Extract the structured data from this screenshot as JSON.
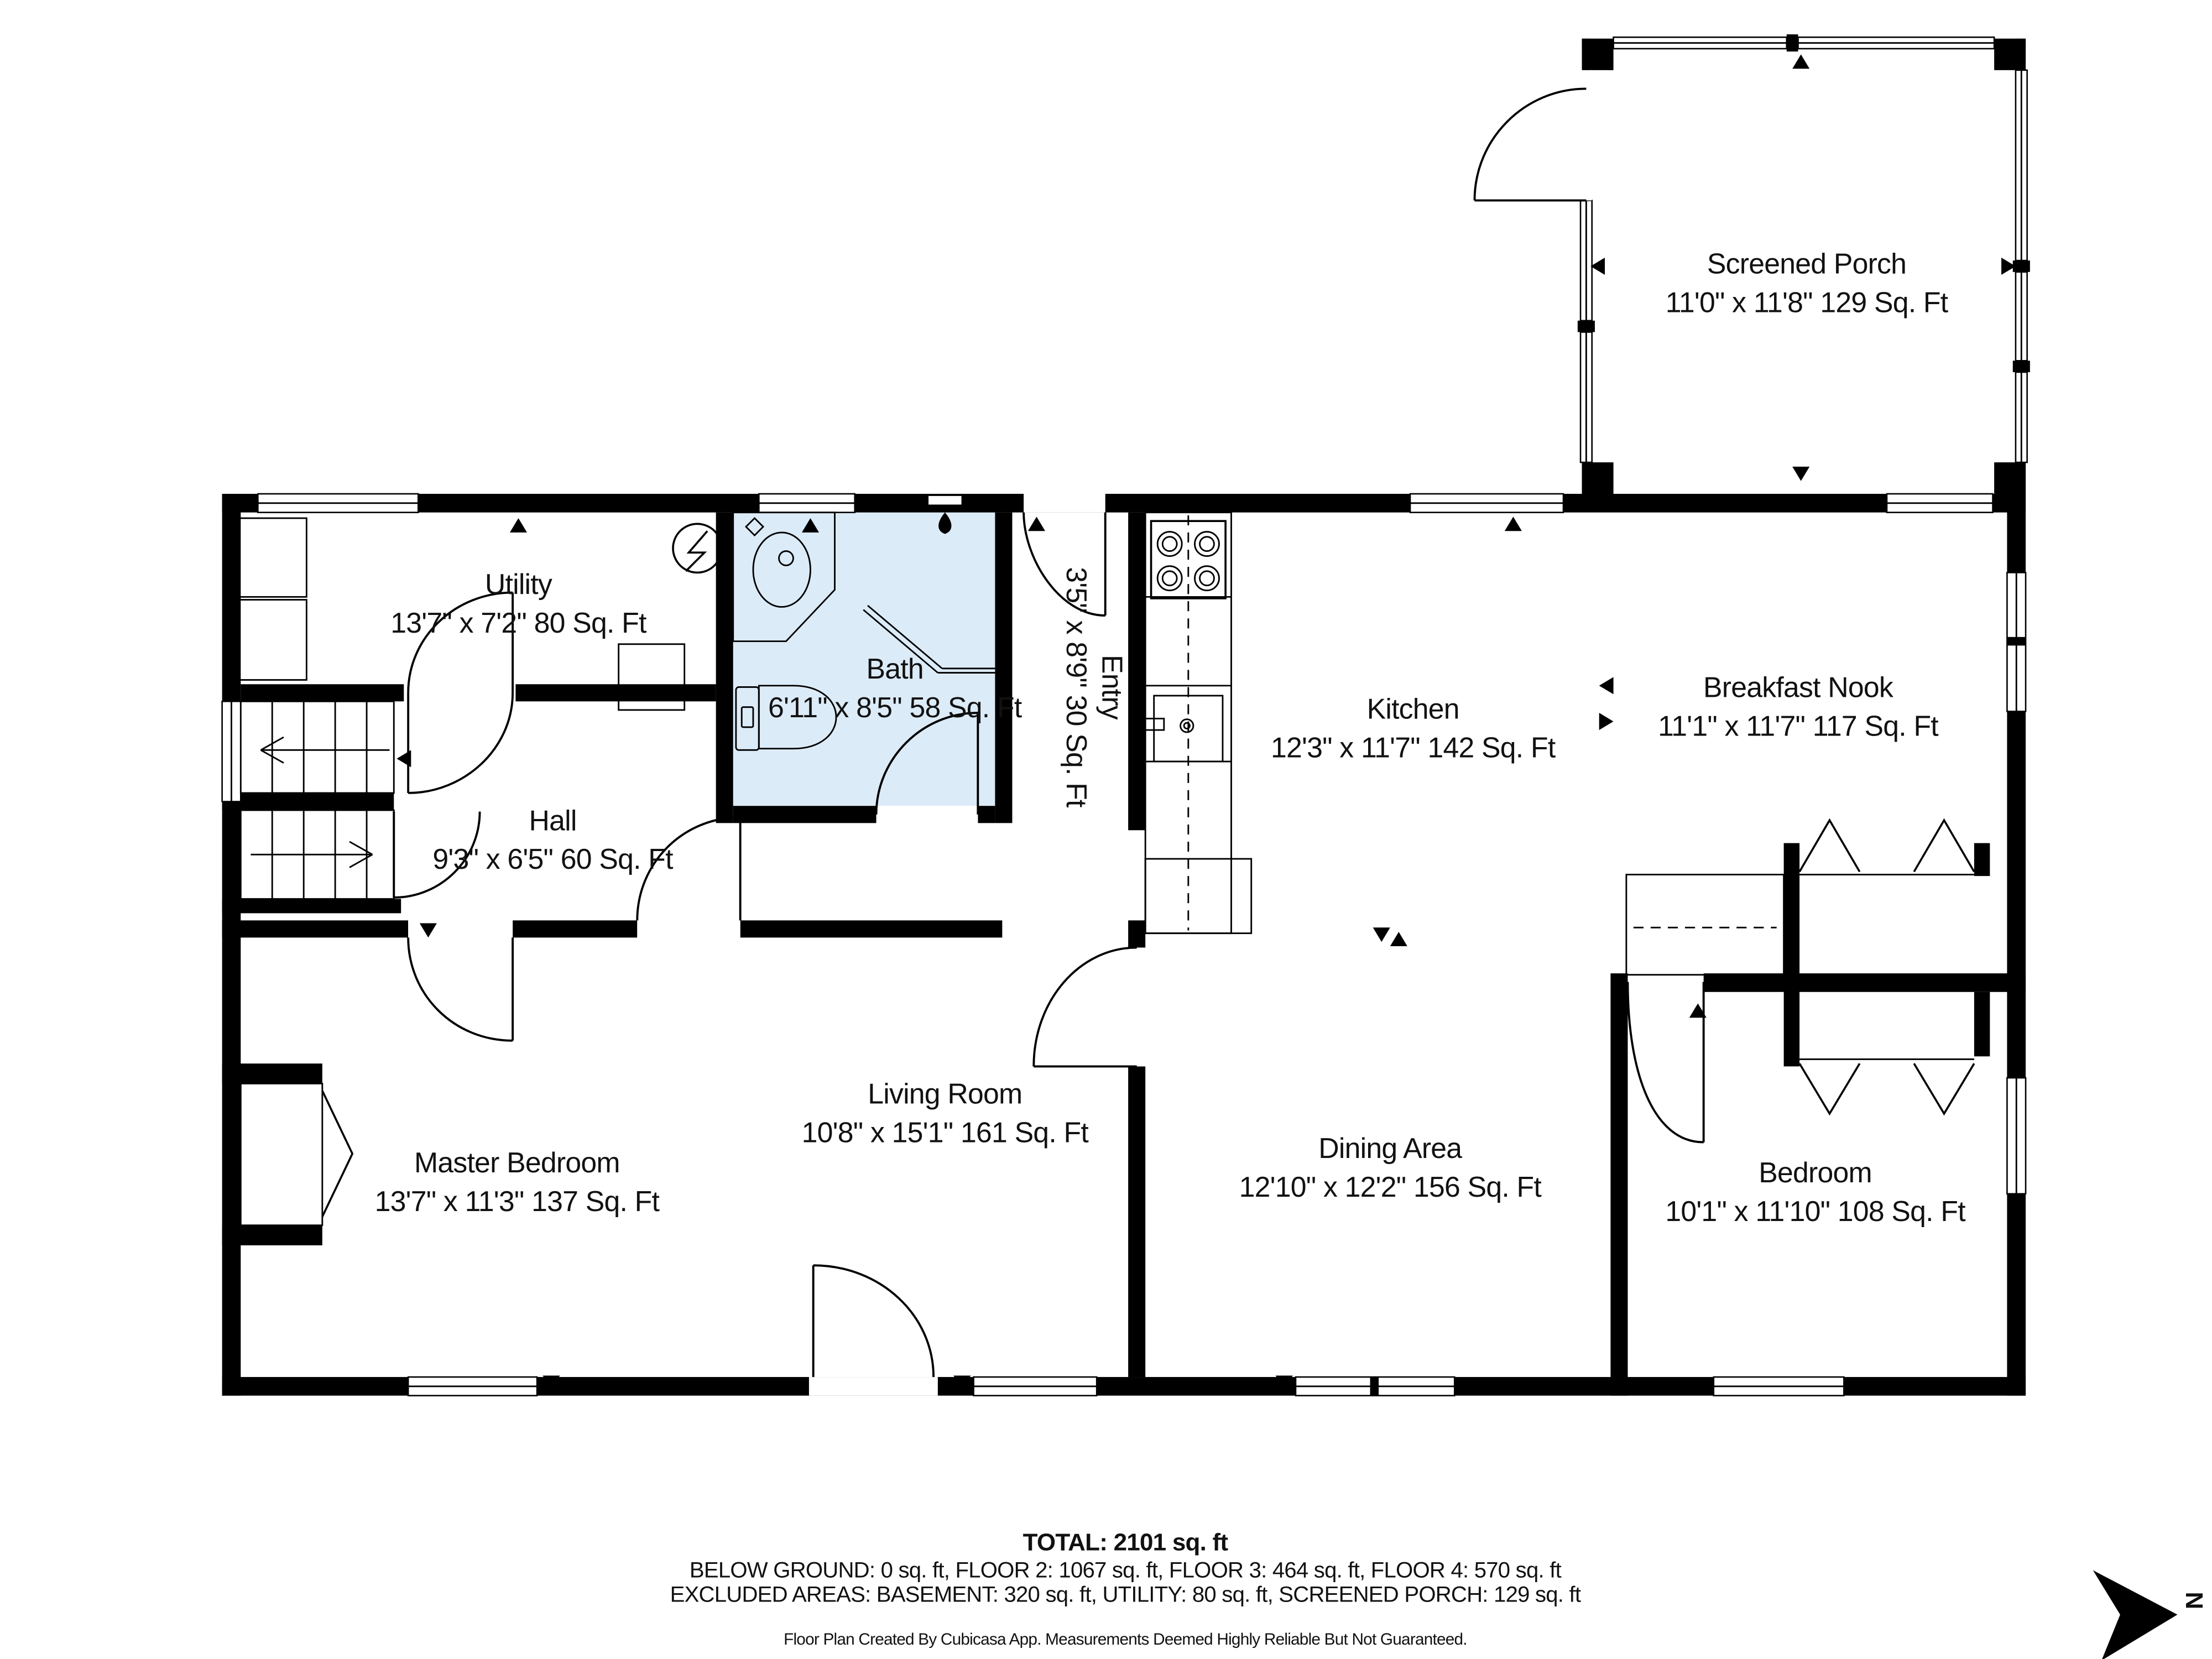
{
  "plan": {
    "rooms": [
      {
        "name": "Screened Porch",
        "dims": "11'0\" x 11'8\" 129 Sq. Ft"
      },
      {
        "name": "Utility",
        "dims": "13'7\" x 7'2\" 80 Sq. Ft"
      },
      {
        "name": "Bath",
        "dims": "6'11\" x 8'5\" 58 Sq. Ft"
      },
      {
        "name": "Entry",
        "dims": "3'5\" x 8'9\" 30 Sq. Ft"
      },
      {
        "name": "Kitchen",
        "dims": "12'3\" x 11'7\" 142 Sq. Ft"
      },
      {
        "name": "Breakfast Nook",
        "dims": "11'1\" x 11'7\" 117 Sq. Ft"
      },
      {
        "name": "Hall",
        "dims": "9'3\" x 6'5\" 60 Sq. Ft"
      },
      {
        "name": "Living Room",
        "dims": "10'8\" x 15'1\" 161 Sq. Ft"
      },
      {
        "name": "Master Bedroom",
        "dims": "13'7\" x 11'3\" 137 Sq. Ft"
      },
      {
        "name": "Dining Area",
        "dims": "12'10\" x 12'2\" 156 Sq. Ft"
      },
      {
        "name": "Bedroom",
        "dims": "10'1\" x 11'10\" 108 Sq. Ft"
      }
    ],
    "footer": {
      "total": "TOTAL: 2101 sq. ft",
      "floors": "BELOW GROUND: 0 sq. ft, FLOOR 2: 1067 sq. ft, FLOOR 3: 464 sq. ft, FLOOR 4: 570 sq. ft",
      "excluded": "EXCLUDED AREAS: BASEMENT: 320 sq. ft, UTILITY: 80 sq. ft, SCREENED PORCH: 129 sq. ft",
      "disclaimer": "Floor Plan Created By Cubicasa App. Measurements Deemed Highly Reliable But Not Guaranteed."
    },
    "compass": {
      "label": "N"
    },
    "colors": {
      "wall": "#000000",
      "bath_floor": "#dcebf8"
    }
  }
}
